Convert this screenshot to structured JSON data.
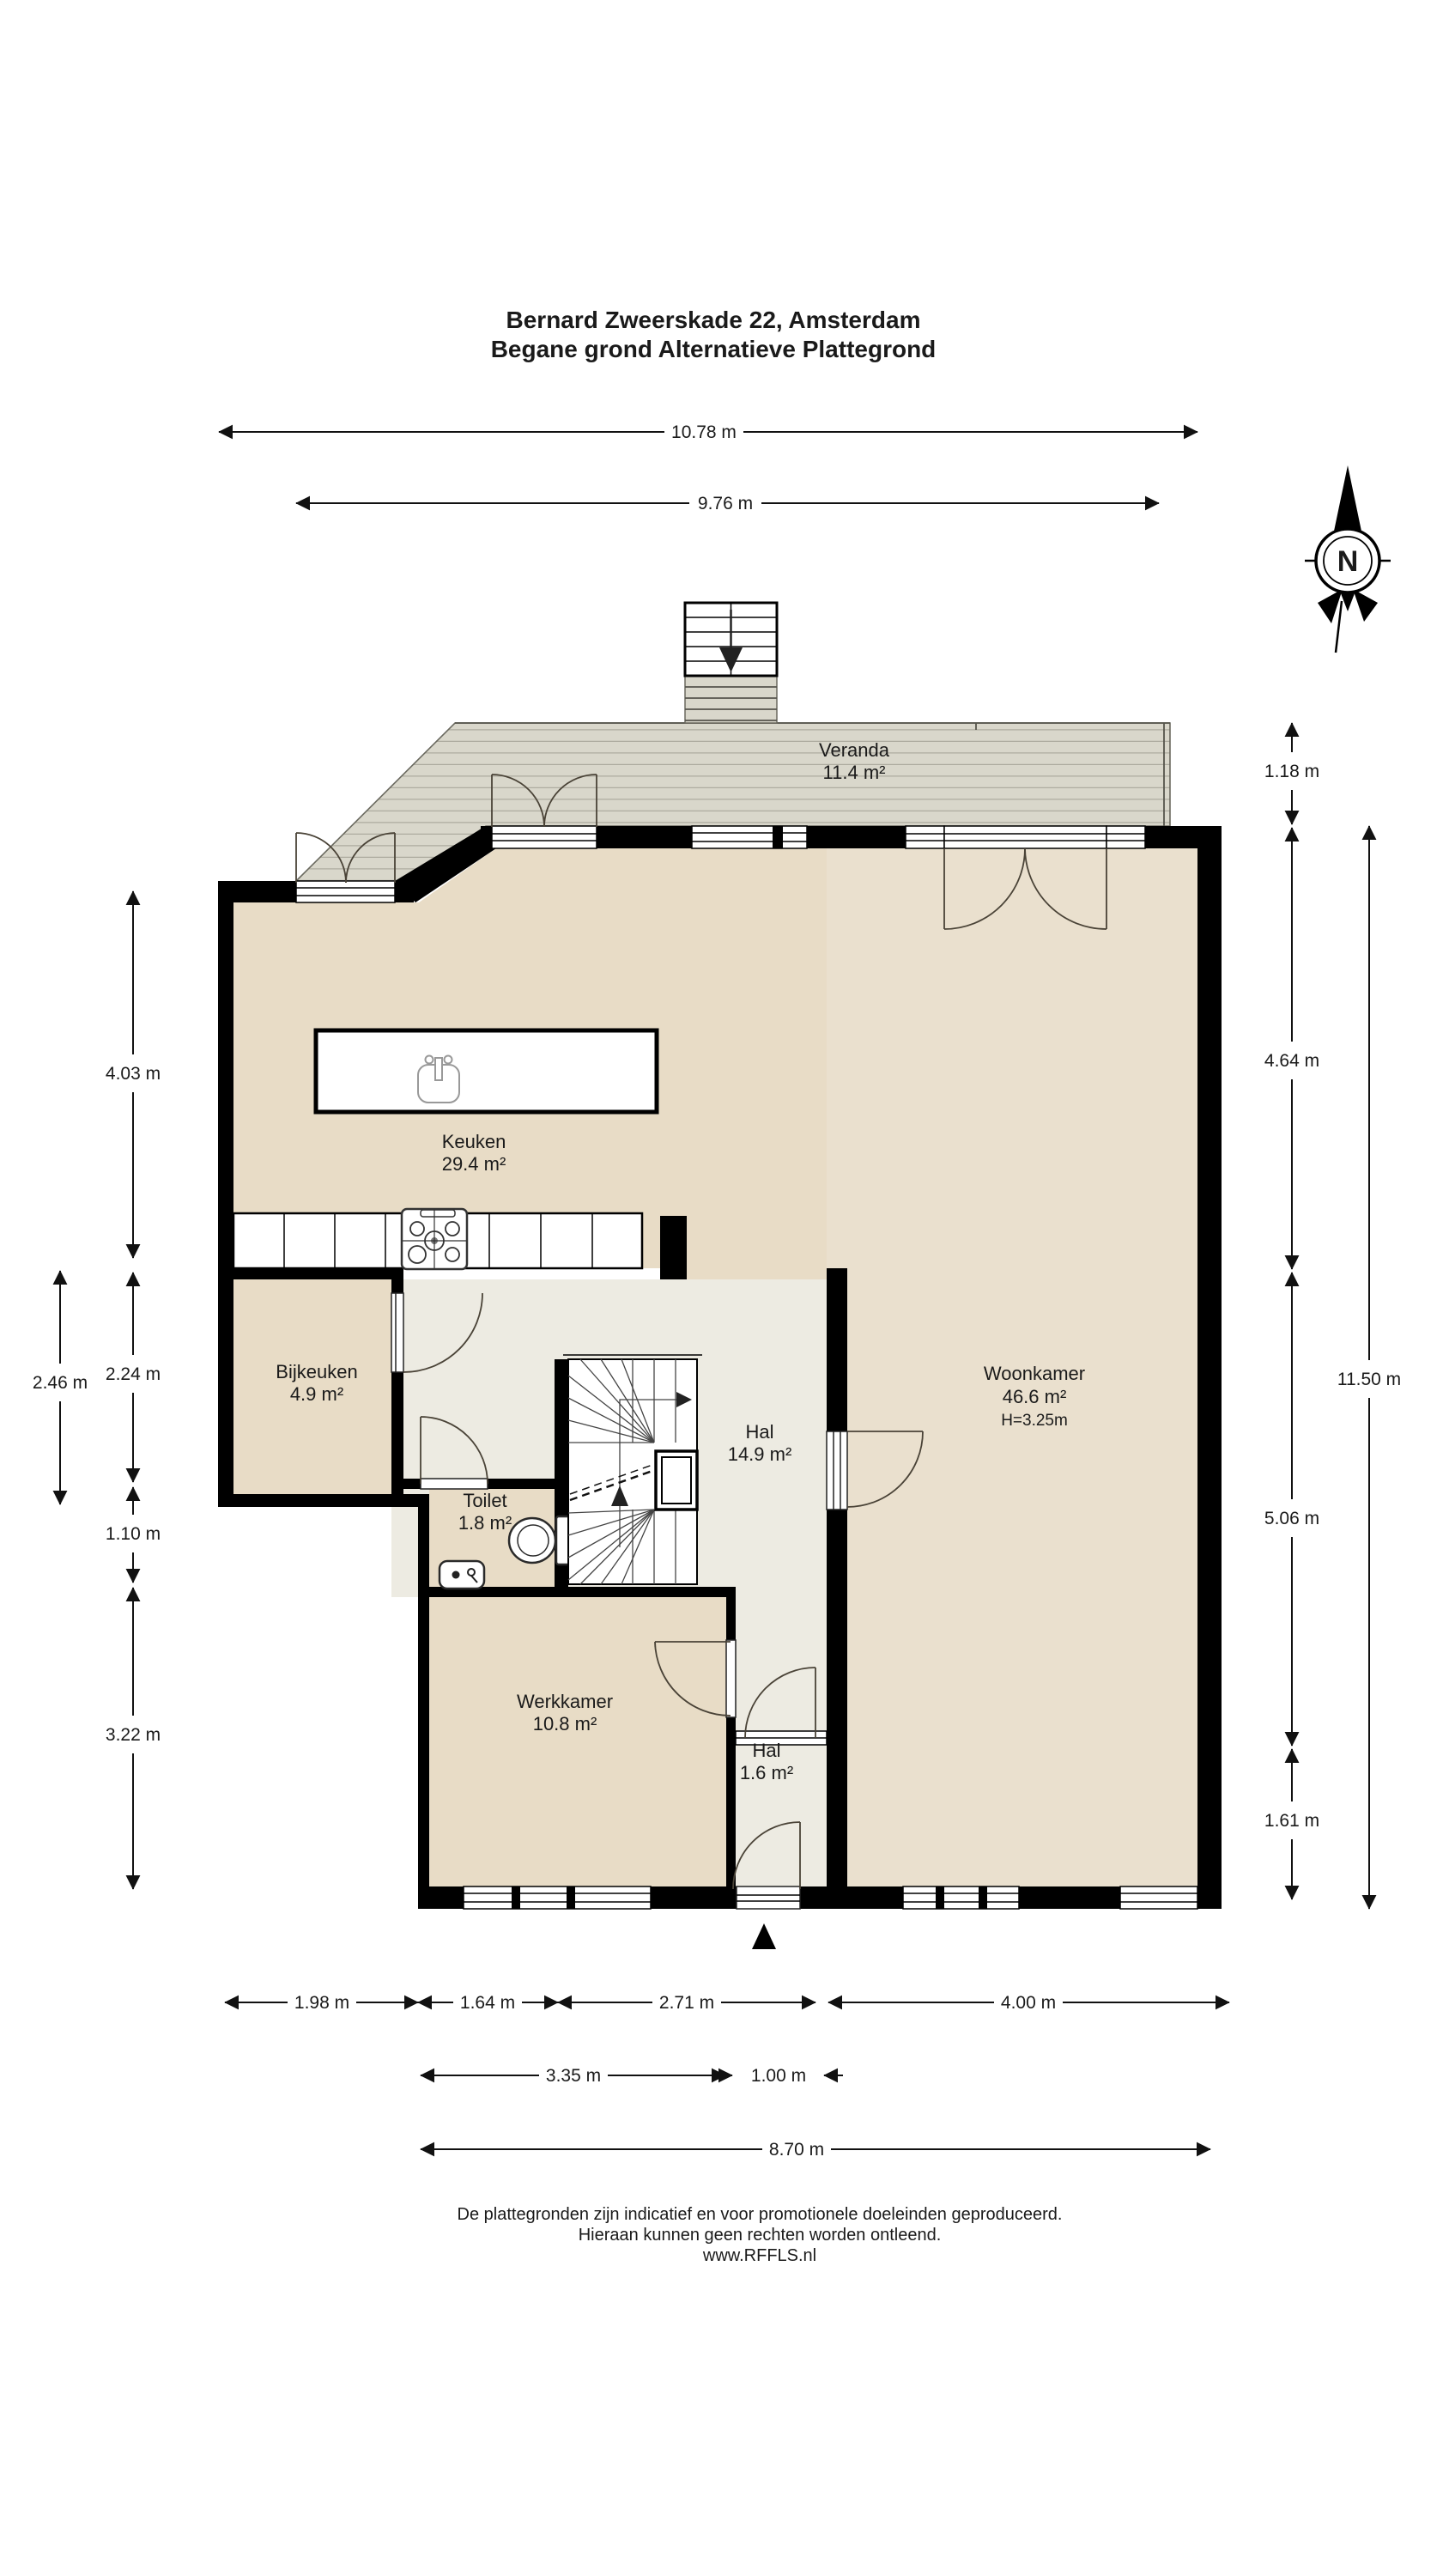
{
  "title": {
    "line1": "Bernard Zweerskade 22, Amsterdam",
    "line2": "Begane grond Alternatieve Plattegrond"
  },
  "rooms": {
    "veranda": {
      "name": "Veranda",
      "area": "11.4 m²"
    },
    "keuken": {
      "name": "Keuken",
      "area": "29.4 m²"
    },
    "bijkeuken": {
      "name": "Bijkeuken",
      "area": "4.9 m²"
    },
    "woonkamer": {
      "name": "Woonkamer",
      "area": "46.6 m²",
      "height": "H=3.25m"
    },
    "hal": {
      "name": "Hal",
      "area": "14.9 m²"
    },
    "toilet": {
      "name": "Toilet",
      "area": "1.8 m²"
    },
    "werkkamer": {
      "name": "Werkkamer",
      "area": "10.8 m²"
    },
    "hal2": {
      "name": "Hal",
      "area": "1.6 m²"
    }
  },
  "dims": {
    "top": [
      "10.78 m",
      "9.76 m"
    ],
    "left": [
      "4.03 m",
      "2.46 m",
      "2.24 m",
      "1.10 m",
      "3.22 m"
    ],
    "right": [
      "1.18 m",
      "4.64 m",
      "5.06 m",
      "1.61 m",
      "11.50 m"
    ],
    "bottom1": [
      "1.98 m",
      "1.64 m",
      "2.71 m",
      "4.00 m"
    ],
    "bottom2": [
      "3.35 m",
      "1.00 m"
    ],
    "bottom3": "8.70 m"
  },
  "compass": {
    "north": "N"
  },
  "footer": {
    "line1": "De plattegronden zijn indicatief en voor promotionele doeleinden geproduceerd.",
    "line2": "Hieraan kunnen geen rechten worden ontleend.",
    "line3": "www.RFFLS.nl"
  },
  "colors": {
    "floor_beige": "#e8dcc6",
    "floor_hall": "#edebe2",
    "deck": "#d9d7cb",
    "wall": "#000000"
  }
}
